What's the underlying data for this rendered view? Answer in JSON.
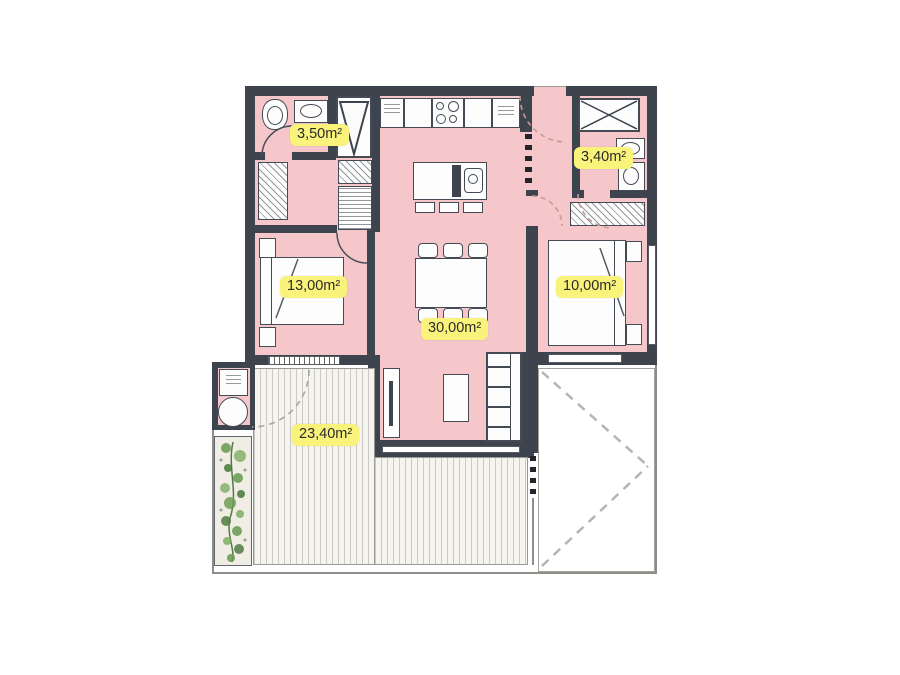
{
  "plan": {
    "type": "apartment-floor-plan",
    "rooms": [
      {
        "id": "bathroom-1",
        "area_label": "3,50m²"
      },
      {
        "id": "bathroom-2",
        "area_label": "3,40m²"
      },
      {
        "id": "bedroom-1",
        "area_label": "13,00m²"
      },
      {
        "id": "bedroom-2",
        "area_label": "10,00m²"
      },
      {
        "id": "living-dining-kitchen",
        "area_label": "30,00m²"
      },
      {
        "id": "terrace",
        "area_label": "23,40m²"
      }
    ],
    "colors": {
      "wall": "#3e444e",
      "floor": "#f5c6ca",
      "label_background": "#f9f37b",
      "deck_stripe": "#c9c9c4",
      "plant_green": "#6d9c55",
      "dashed_line": "#b5b5b0"
    },
    "fixtures": [
      "double-bed",
      "single-bed",
      "dining-table-six-chairs",
      "kitchen-counter",
      "kitchen-island",
      "sofa",
      "coffee-table",
      "tv-stand",
      "toilet",
      "washbasin",
      "shower-duct",
      "wardrobe",
      "washer",
      "water-heater",
      "planter"
    ]
  }
}
